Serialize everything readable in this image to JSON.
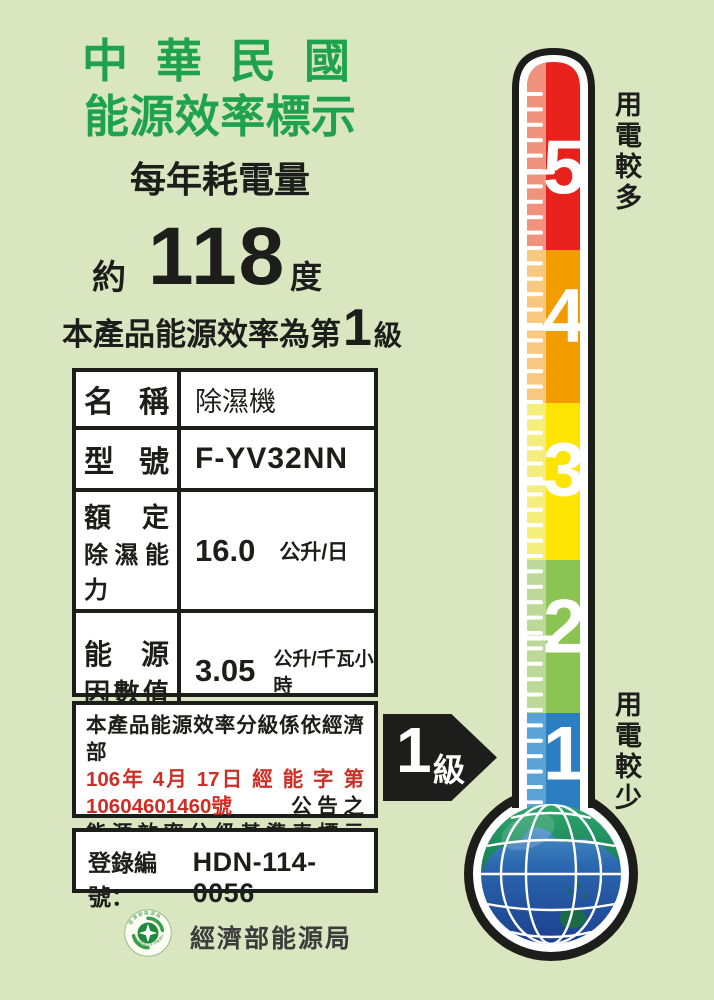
{
  "header": {
    "title_line1": "中華民國",
    "title_line2": "能源效率標示",
    "subtitle": "每年耗電量",
    "approx": "約",
    "annual_consumption_value": "118",
    "unit": "度",
    "grade_prefix": "本產品能源效率為第",
    "grade_number": "1",
    "grade_suffix": "級",
    "title_color": "#1fa24e"
  },
  "spec_table": {
    "rows": [
      {
        "label": "名稱",
        "value": "除濕機"
      },
      {
        "label": "型號",
        "value": "F-YV32NN"
      },
      {
        "label_line1": "額定",
        "label_line2": "除濕能力",
        "value": "16.0",
        "unit": "公升/日"
      },
      {
        "label_line1": "能源",
        "label_line2": "因數值",
        "value": "3.05",
        "unit": "公升/千瓦小時"
      }
    ]
  },
  "notice": {
    "line1": "本產品能源效率分級係依經濟部",
    "line2_red": "106年 4月 17日 經 能 字 第",
    "line3_red": "10604601460號",
    "line3_black": "公 告 之",
    "line4": "能源效率分級基準表標示",
    "red_color": "#cd2e26"
  },
  "registration": {
    "label": "登錄編號：",
    "number": "HDN-114-0056"
  },
  "footer": {
    "agency": "經濟部能源局"
  },
  "seal": {
    "top_text": "經濟部能源局",
    "bottom_text": "BUREAU OF ENERGY"
  },
  "thermometer": {
    "top_note": "用電較多",
    "bottom_note": "用電較少",
    "levels": [
      {
        "value": "5",
        "color": "#e8211c",
        "light_color": "#f0937e"
      },
      {
        "value": "4",
        "color": "#f39c00",
        "light_color": "#f8c87e"
      },
      {
        "value": "3",
        "color": "#ffe400",
        "light_color": "#f5ee7d"
      },
      {
        "value": "2",
        "color": "#8cc453",
        "light_color": "#bcd999"
      },
      {
        "value": "1",
        "color": "#2b7ec2",
        "light_color": "#5aa3d6"
      }
    ],
    "pointer": {
      "value": "1",
      "suffix": "級",
      "color": "#1d1d1b"
    }
  }
}
